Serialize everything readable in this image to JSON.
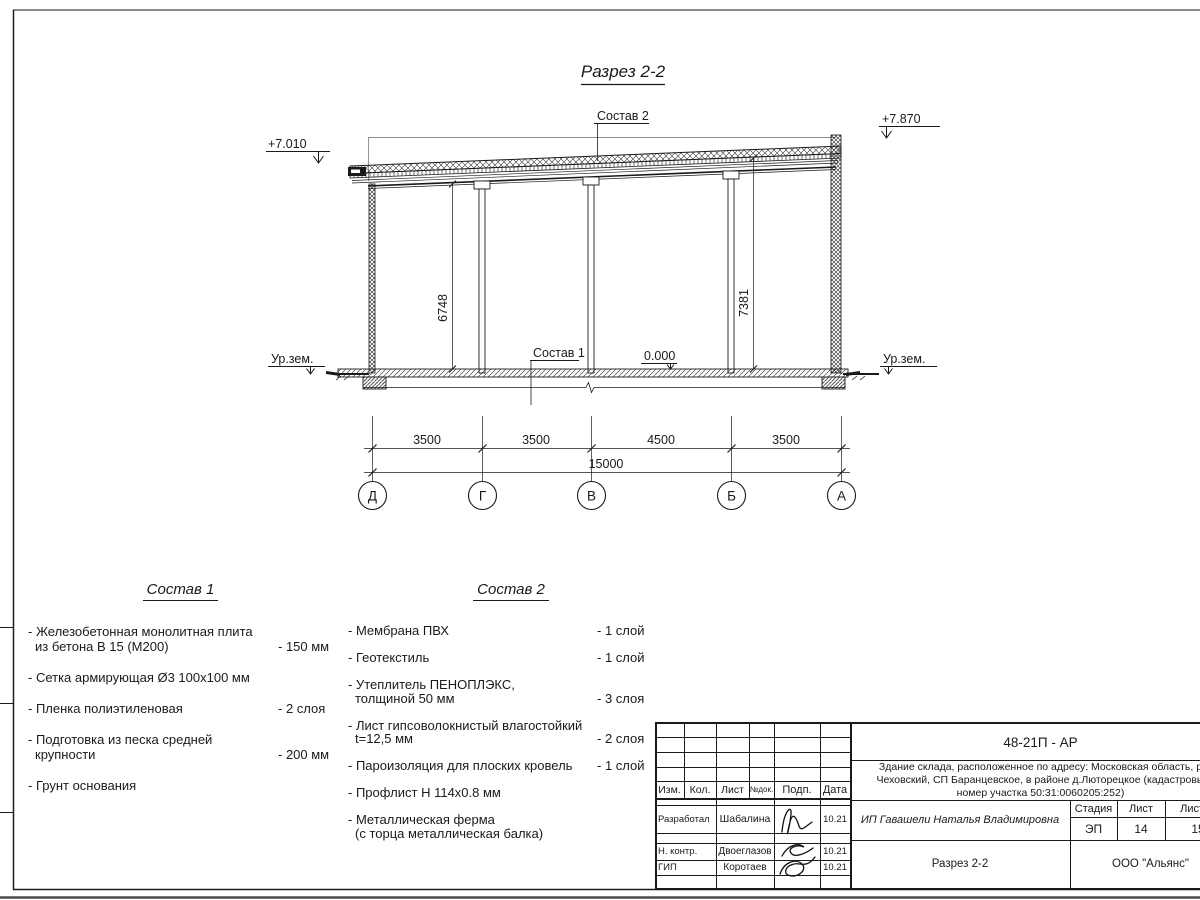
{
  "sheet": {
    "title": "Разрез 2-2"
  },
  "drawing": {
    "roof_label": "Состав 2",
    "floor_label": "Состав 1",
    "elev_left": "+7.010",
    "elev_right": "+7.870",
    "elev_zero": "0.000",
    "ground_label_left": "Ур.зем.",
    "ground_label_right": "Ур.зем.",
    "vertical_dims": [
      "6748",
      "7381"
    ],
    "bay_dims": [
      "3500",
      "3500",
      "4500",
      "3500"
    ],
    "total_dim": "15000",
    "axes": [
      "Д",
      "Г",
      "В",
      "Б",
      "А"
    ]
  },
  "sostav1": {
    "title": "Состав 1",
    "items": [
      {
        "line1": "- Железобетонная  монолитная плита",
        "line2": "из бетона В 15 (М200)",
        "value": "- 150 мм"
      },
      {
        "line1": "- Сетка армирующая Ø3 100х100 мм"
      },
      {
        "line1": "- Пленка полиэтиленовая",
        "value": "-  2 слоя"
      },
      {
        "line1": "- Подготовка из песка средней",
        "line2": "крупности",
        "value": "- 200 мм"
      },
      {
        "line1": "- Грунт основания"
      }
    ]
  },
  "sostav2": {
    "title": "Состав 2",
    "items": [
      {
        "line1": "- Мембрана ПВХ",
        "value": "- 1 слой"
      },
      {
        "line1": "- Геотекстиль",
        "value": "- 1 слой"
      },
      {
        "line1": "- Утеплитель ПЕНОПЛЭКС,",
        "line2": "толщиной 50 мм",
        "value": "- 3 слоя"
      },
      {
        "line1": "- Лист гипсоволокнистый влагостойкий",
        "line2": "t=12,5 мм",
        "value": "- 2 слоя"
      },
      {
        "line1": "- Пароизоляция для плоских кровель",
        "value": "- 1 слой"
      },
      {
        "line1": "- Профлист Н 114х0.8 мм"
      },
      {
        "line1": "- Металлическая ферма",
        "line2": "(с торца металлическая балка)"
      }
    ]
  },
  "titleblock": {
    "doc_number": "48-21П - АР",
    "description": [
      "Здание склада, расположенное по адресу: Московская область, р",
      "Чеховский, СП Баранцевское, в районе д.Люторецкое  (кадастровы",
      "номер участка 50:31:0060205:252)"
    ],
    "cols": {
      "izm": "Изм.",
      "kol": "Кол.",
      "list": "Лист",
      "ndok": "№док.",
      "podp": "Подп.",
      "data": "Дата"
    },
    "rows": [
      {
        "role": "Разработал",
        "name": "Шабалина",
        "date": "10.21"
      },
      {
        "role": "Н. контр.",
        "name": "Двоеглазов",
        "date": "10.21"
      },
      {
        "role": "ГИП",
        "name": "Коротаев",
        "date": "10.21"
      }
    ],
    "client": "ИП Гавашели Наталья Владимировна",
    "stage_label": "Стадия",
    "list_label": "Лист",
    "listov_label": "Листов",
    "stage": "ЭП",
    "sheet_no": "14",
    "sheets_total": "15",
    "sheet_title": "Разрез 2-2",
    "company": "ООО \"Альянс\"",
    "ink": "#1a1a1a"
  }
}
